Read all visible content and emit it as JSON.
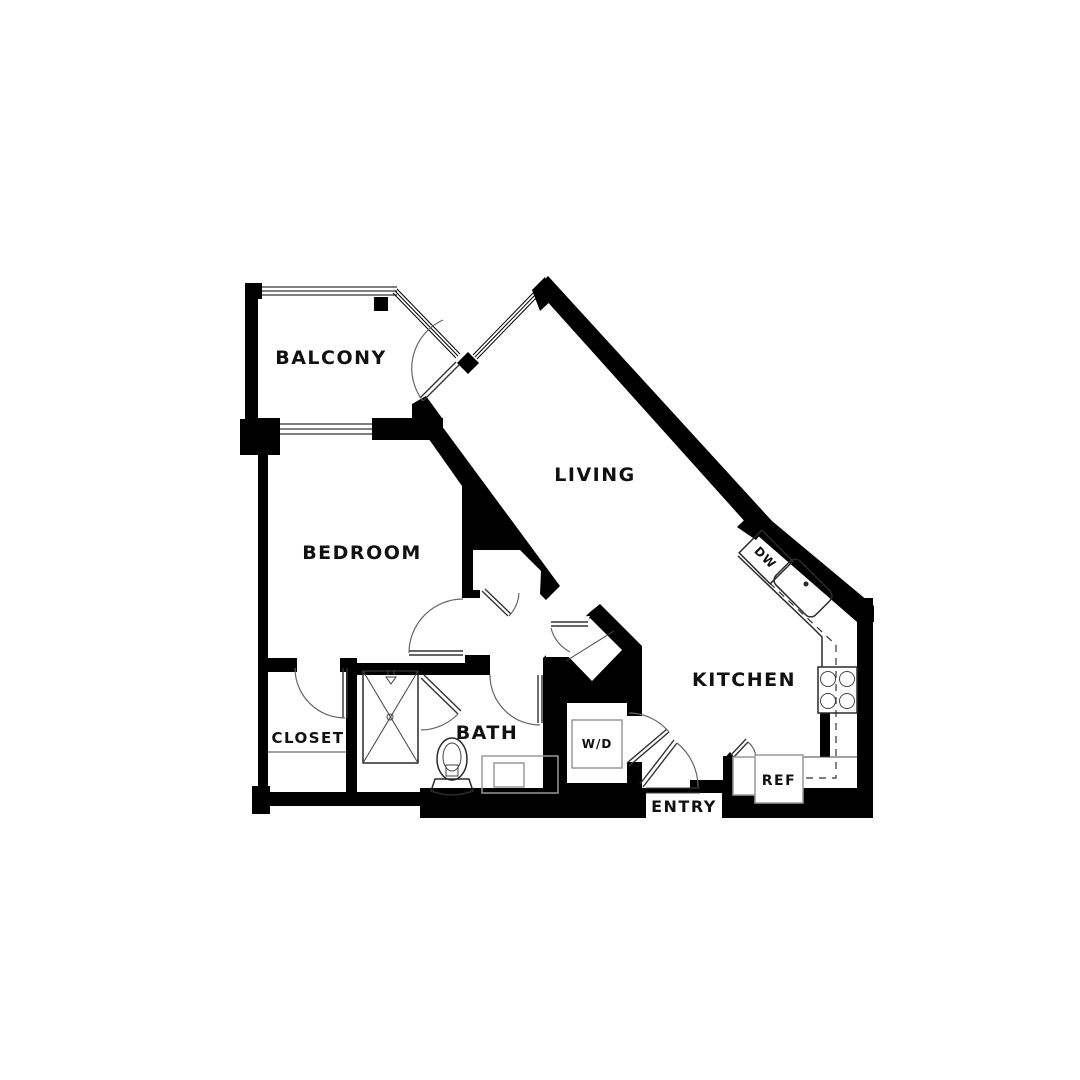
{
  "plan": {
    "type": "apartment-floor-plan",
    "rooms": [
      {
        "id": "balcony",
        "label": "BALCONY"
      },
      {
        "id": "living",
        "label": "LIVING"
      },
      {
        "id": "bedroom",
        "label": "BEDROOM"
      },
      {
        "id": "closet",
        "label": "CLOSET"
      },
      {
        "id": "bath",
        "label": "BATH"
      },
      {
        "id": "wd",
        "label": "W/D"
      },
      {
        "id": "entry",
        "label": "ENTRY"
      },
      {
        "id": "kitchen",
        "label": "KITCHEN"
      }
    ],
    "appliances": [
      {
        "id": "dw",
        "label": "DW"
      },
      {
        "id": "ref",
        "label": "REF"
      }
    ]
  },
  "labels": {
    "balcony": "BALCONY",
    "living": "LIVING",
    "bedroom": "BEDROOM",
    "closet": "CLOSET",
    "bath": "BATH",
    "wd": "W/D",
    "entry": "ENTRY",
    "kitchen": "KITCHEN",
    "dw": "DW",
    "ref": "REF"
  },
  "colors": {
    "wall": "#000000",
    "background": "#ffffff",
    "fixture_outline": "#2a2a2a",
    "cabinet_gray": "#999999"
  }
}
